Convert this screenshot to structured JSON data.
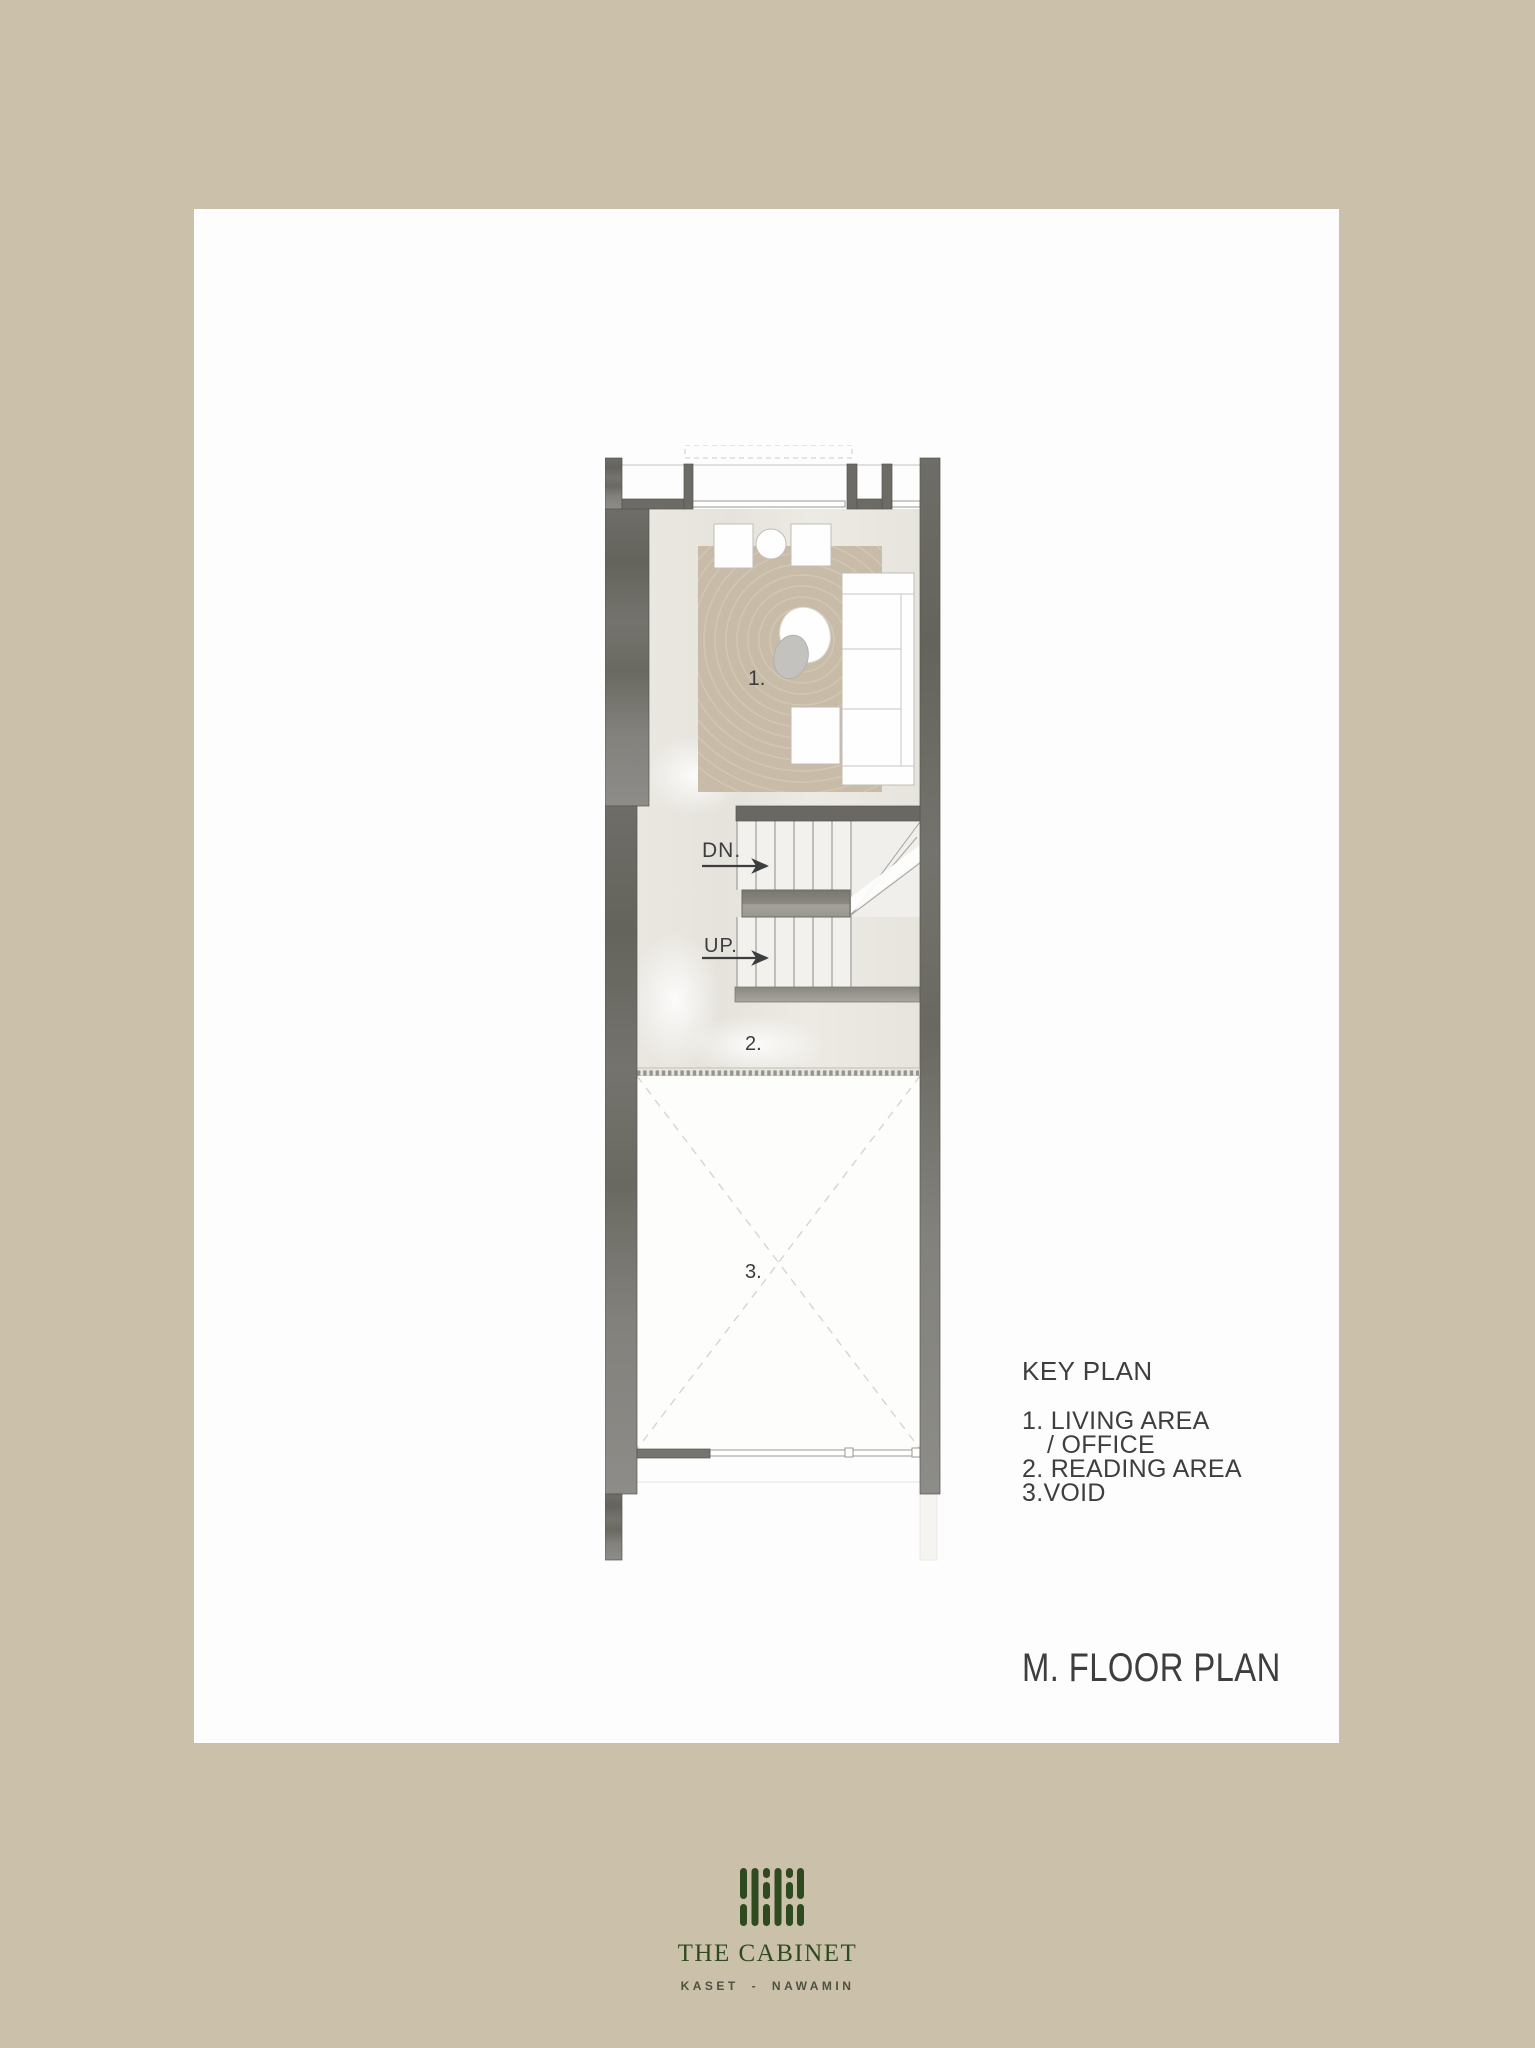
{
  "page": {
    "background_color": "#cbc1ab",
    "card_color": "#fdfdfd"
  },
  "plan": {
    "labels": {
      "area_1": "1.",
      "area_2": "2.",
      "area_3": "3.",
      "down": "DN.",
      "up": "UP."
    },
    "colors": {
      "wall": "#6b6a66",
      "floor": "#eae7e1",
      "rug": "#c8bca8",
      "void": "#fdfdfc"
    }
  },
  "key_plan": {
    "title": "KEY PLAN",
    "items": [
      {
        "text": "1. LIVING AREA"
      },
      {
        "text": "/ OFFICE"
      },
      {
        "text": "2. READING AREA"
      },
      {
        "text": "3.VOID"
      }
    ]
  },
  "title": "M. FLOOR PLAN",
  "brand": {
    "name": "THE CABINET",
    "location": "KASET - NAWAMIN",
    "color": "#2f4a1f"
  }
}
